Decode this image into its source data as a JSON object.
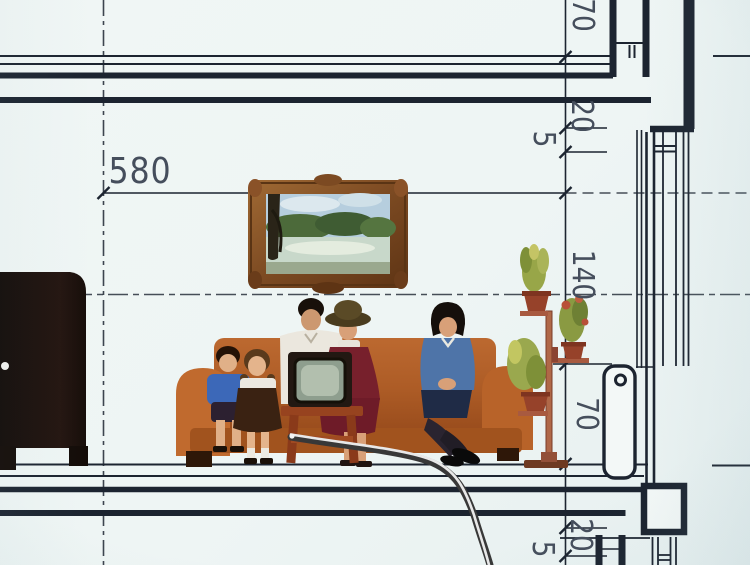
{
  "dimensions": {
    "room_width": "580",
    "right_chain": [
      "70",
      "20",
      "5",
      "140",
      "70",
      "20",
      "5"
    ]
  },
  "scene": {
    "items": [
      "tv-cabinet",
      "framed-landscape-painting",
      "sofa",
      "boy",
      "girl",
      "man",
      "woman-in-hat",
      "television-on-stand",
      "woman-in-blue",
      "plant-stand",
      "radiator",
      "pointer-stick"
    ]
  },
  "colors": {
    "paper": "#eef5f4",
    "ink": "#1c2430",
    "label": "#454e5c",
    "sofa_orange": "#b4612b",
    "dress_red": "#77202c",
    "jacket_blue": "#4e74a8",
    "wood_red": "#97431f"
  }
}
